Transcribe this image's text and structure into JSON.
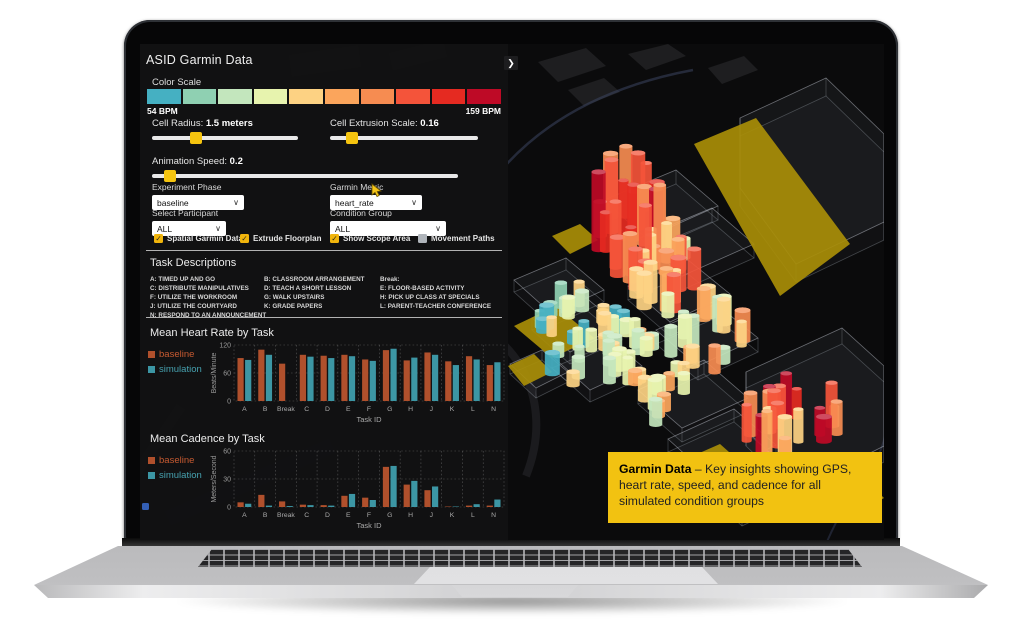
{
  "app": {
    "title": "ASID Garmin Data"
  },
  "panel": {
    "collapse_arrow": "❯",
    "color_scale": {
      "label": "Color Scale",
      "min_label": "54 BPM",
      "max_label": "159 BPM",
      "colors": [
        "#45b0c2",
        "#8fd0b2",
        "#c3e6bd",
        "#e7f3ae",
        "#fdd283",
        "#fba55c",
        "#f68c51",
        "#f4543a",
        "#e52a21",
        "#be0a26"
      ]
    },
    "sliders": [
      {
        "label": "Cell Radius:",
        "value": "1.5 meters",
        "percent": 30
      },
      {
        "label": "Cell Extrusion Scale:",
        "value": "0.16",
        "percent": 15
      },
      {
        "label": "Animation Speed:",
        "value": "0.2",
        "percent": 6
      }
    ],
    "dropdowns": [
      {
        "label": "Experiment Phase",
        "value": "baseline"
      },
      {
        "label": "Garmin Metric",
        "value": "heart_rate"
      },
      {
        "label": "Select Participant",
        "value": "ALL"
      },
      {
        "label": "Condition Group",
        "value": "ALL"
      }
    ],
    "checkboxes": [
      {
        "label": "Spatial Garmin Data",
        "checked": true
      },
      {
        "label": "Extrude Floorplan",
        "checked": true
      },
      {
        "label": "Show Scope Area",
        "checked": true
      },
      {
        "label": "Movement Paths",
        "checked": false
      }
    ],
    "tasks": {
      "title": "Task Descriptions",
      "columns": [
        [
          "A: TIMED UP AND GO",
          "C: DISTRIBUTE MANIPULATIVES",
          "F: UTILIZE THE WORKROOM",
          "J: UTILIZE THE COURTYARD",
          "N: RESPOND TO AN ANNOUNCEMENT"
        ],
        [
          "B: CLASSROOM ARRANGEMENT",
          "D: TEACH A SHORT LESSON",
          "G: WALK UPSTAIRS",
          "K: GRADE PAPERS"
        ],
        [
          "Break:",
          "E: FLOOR-BASED ACTIVITY",
          "H: PICK UP CLASS AT SPECIALS",
          "L: PARENT-TEACHER CONFERENCE"
        ]
      ]
    }
  },
  "chart_data": [
    {
      "type": "bar",
      "title": "Mean Heart Rate by Task",
      "xlabel": "Task ID",
      "ylabel": "Beats/Minute",
      "ylim": [
        0,
        120
      ],
      "yticks": [
        0,
        60,
        120
      ],
      "grid": "dashed",
      "legend_position": "left",
      "categories": [
        "A",
        "B",
        "Break",
        "C",
        "D",
        "E",
        "F",
        "G",
        "H",
        "J",
        "K",
        "L",
        "N"
      ],
      "series": [
        {
          "name": "baseline",
          "color": "#b0502c",
          "values": [
            92,
            110,
            80,
            99,
            97,
            99,
            89,
            109,
            87,
            104,
            85,
            96,
            77
          ]
        },
        {
          "name": "simulation",
          "color": "#3c96a4",
          "values": [
            88,
            99,
            null,
            95,
            92,
            96,
            86,
            112,
            93,
            99,
            77,
            89,
            83
          ]
        }
      ]
    },
    {
      "type": "bar",
      "title": "Mean Cadence by Task",
      "xlabel": "Task ID",
      "ylabel": "Meters/Second",
      "ylim": [
        0,
        60
      ],
      "yticks": [
        0,
        30,
        60
      ],
      "grid": "dashed",
      "legend_position": "left",
      "categories": [
        "A",
        "B",
        "Break",
        "C",
        "D",
        "E",
        "F",
        "G",
        "H",
        "J",
        "K",
        "L",
        "N"
      ],
      "series": [
        {
          "name": "baseline",
          "color": "#b0502c",
          "values": [
            5,
            13,
            6,
            2.5,
            2,
            12,
            10,
            43,
            24,
            18,
            0.5,
            1.5,
            1.5
          ]
        },
        {
          "name": "simulation",
          "color": "#3c96a4",
          "values": [
            3.5,
            1.5,
            1,
            2,
            1.5,
            14,
            7.5,
            44,
            28,
            22,
            0.5,
            3,
            8
          ]
        }
      ]
    }
  ],
  "callout": {
    "title": "Garmin Data",
    "text": "– Key insights showing GPS, heart rate, speed, and cadence for all simulated condition groups",
    "bg": "#f2c211"
  },
  "colors": {
    "accent_yellow": "#f5c40f",
    "checkbox_yellow": "#f1b50c",
    "scope_yellow": "#a98e08",
    "legend_baseline_text": "#c65a31",
    "legend_simulation_text": "#46a1af"
  },
  "viz": {
    "clusters": [
      {
        "cx": 122,
        "cy": 192,
        "rx": 36,
        "ry": 48,
        "n": 20,
        "h": [
          34,
          78
        ],
        "c": [
          6,
          9
        ]
      },
      {
        "cx": 152,
        "cy": 242,
        "rx": 40,
        "ry": 40,
        "n": 22,
        "h": [
          18,
          42
        ],
        "c": [
          3,
          7
        ]
      },
      {
        "cx": 74,
        "cy": 300,
        "rx": 46,
        "ry": 46,
        "n": 30,
        "h": [
          10,
          26
        ],
        "c": [
          0,
          4
        ]
      },
      {
        "cx": 136,
        "cy": 340,
        "rx": 44,
        "ry": 44,
        "n": 26,
        "h": [
          12,
          30
        ],
        "c": [
          2,
          5
        ]
      },
      {
        "cx": 205,
        "cy": 300,
        "rx": 30,
        "ry": 36,
        "n": 14,
        "h": [
          14,
          34
        ],
        "c": [
          2,
          6
        ]
      },
      {
        "cx": 290,
        "cy": 398,
        "rx": 52,
        "ry": 30,
        "n": 20,
        "h": [
          18,
          46
        ],
        "c": [
          4,
          9
        ]
      },
      {
        "cx": 238,
        "cy": 440,
        "rx": 26,
        "ry": 20,
        "n": 8,
        "h": [
          14,
          30
        ],
        "c": [
          3,
          6
        ]
      }
    ]
  }
}
